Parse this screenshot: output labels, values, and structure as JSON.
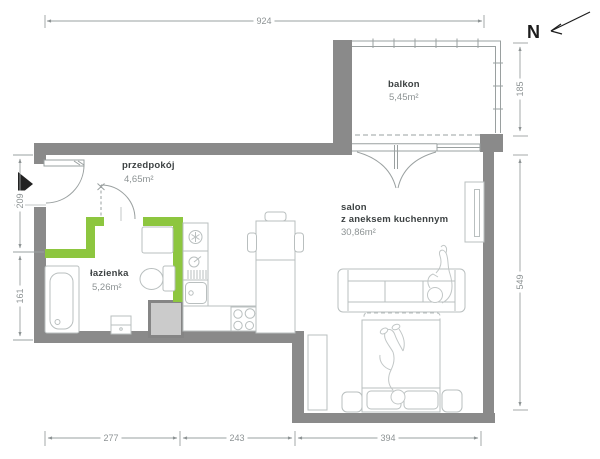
{
  "north": {
    "label": "N"
  },
  "rooms": {
    "balcony": {
      "name": "balkon",
      "area": "5,45m²"
    },
    "hall": {
      "name": "przedpokój",
      "area": "4,65m²"
    },
    "bath": {
      "name": "łazienka",
      "area": "5,26m²"
    },
    "living": {
      "name": "salon",
      "subtitle": "z aneksem kuchennym",
      "area": "30,86m²"
    }
  },
  "dimensions": {
    "top_width": "924",
    "balcony_height": "185",
    "right_height": "549",
    "left_upper": "209",
    "left_lower": "161",
    "bottom_left": "277",
    "bottom_middle": "243",
    "bottom_right": "394"
  },
  "colors": {
    "wall_gray": "#8a8a8a",
    "highlight_green": "#8dc63f",
    "furniture_line": "#b9bfbf",
    "dimension_line": "#9aa0a0"
  }
}
